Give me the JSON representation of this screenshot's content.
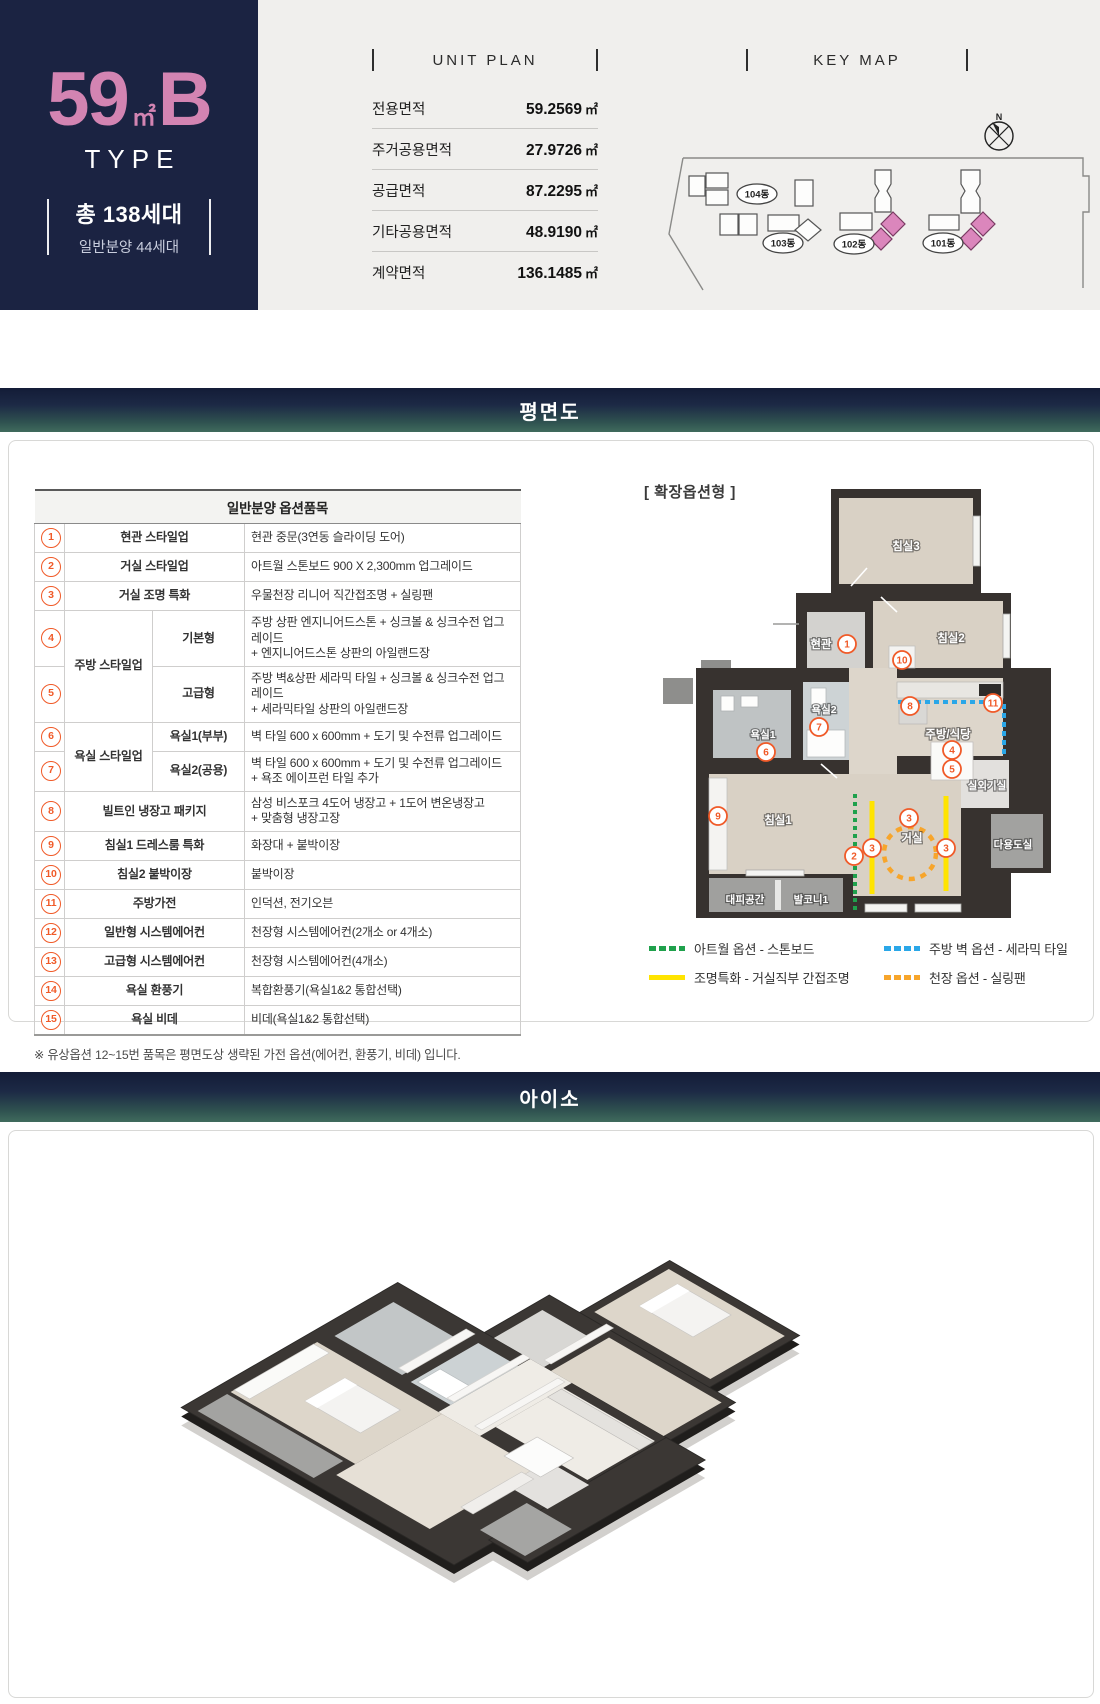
{
  "hero": {
    "size": "59",
    "size_unit": "㎡",
    "letter": "B",
    "type_label": "TYPE",
    "total_units": "총 138세대",
    "general_sale": "일반분양 44세대"
  },
  "unit_plan": {
    "title": "UNIT PLAN",
    "rows": [
      {
        "label": "전용면적",
        "value": "59.2569",
        "unit": "㎡"
      },
      {
        "label": "주거공용면적",
        "value": "27.9726",
        "unit": "㎡"
      },
      {
        "label": "공급면적",
        "value": "87.2295",
        "unit": "㎡"
      },
      {
        "label": "기타공용면적",
        "value": "48.9190",
        "unit": "㎡"
      },
      {
        "label": "계약면적",
        "value": "136.1485",
        "unit": "㎡"
      }
    ]
  },
  "key_map": {
    "title": "KEY MAP",
    "compass": "N",
    "building_labels": [
      "104동",
      "103동",
      "102동",
      "101동"
    ]
  },
  "floorplan": {
    "bar_title": "평면도",
    "variant": "[ 확장옵션형 ]",
    "table": {
      "title": "일반분양 옵션품목",
      "rows": [
        {
          "num": "1",
          "cat": "현관 스타일업",
          "desc1": "현관 중문(3연동 슬라이딩 도어)"
        },
        {
          "num": "2",
          "cat": "거실 스타일업",
          "desc1": "아트월 스톤보드 900 X 2,300mm 업그레이드"
        },
        {
          "num": "3",
          "cat": "거실 조명 특화",
          "desc1": "우물천장 리니어 직간접조명 + 실링팬"
        },
        {
          "num": "4",
          "group": "주방 스타일업",
          "sub": "기본형",
          "desc1": "주방 상판 엔지니어드스톤 + 싱크볼 & 싱크수전 업그레이드",
          "desc2": "+ 엔지니어드스톤 상판의 아일랜드장"
        },
        {
          "num": "5",
          "sub": "고급형",
          "desc1": "주방 벽&상판 세라믹 타일 + 싱크볼 & 싱크수전 업그레이드",
          "desc2": "+ 세라믹타일 상판의 아일랜드장"
        },
        {
          "num": "6",
          "group": "욕실 스타일업",
          "sub": "욕실1(부부)",
          "desc1": "벽 타일 600 x 600mm + 도기 및 수전류 업그레이드"
        },
        {
          "num": "7",
          "sub": "욕실2(공용)",
          "desc1": "벽 타일 600 x 600mm + 도기 및 수전류 업그레이드",
          "desc2": "+ 욕조 에이프런 타일 추가"
        },
        {
          "num": "8",
          "cat": "빌트인 냉장고 패키지",
          "desc1": "삼성 비스포크 4도어 냉장고 + 1도어 변온냉장고",
          "desc2": "+ 맞춤형 냉장고장"
        },
        {
          "num": "9",
          "cat": "침실1 드레스룸 특화",
          "desc1": "화장대 + 붙박이장"
        },
        {
          "num": "10",
          "cat": "침실2 붙박이장",
          "desc1": "붙박이장"
        },
        {
          "num": "11",
          "cat": "주방가전",
          "desc1": "인덕션, 전기오븐"
        },
        {
          "num": "12",
          "cat": "일반형 시스템에어컨",
          "desc1": "천장형 시스템에어컨(2개소 or 4개소)"
        },
        {
          "num": "13",
          "cat": "고급형 시스템에어컨",
          "desc1": "천장형 시스템에어컨(4개소)"
        },
        {
          "num": "14",
          "cat": "욕실 환풍기",
          "desc1": "복합환풍기(욕실1&2 통합선택)"
        },
        {
          "num": "15",
          "cat": "욕실 비데",
          "desc1": "비데(욕실1&2 통합선택)"
        }
      ]
    },
    "footnote": "※ 유상옵션 12~15번 품목은 평면도상 생략된 가전 옵션(에어컨, 환풍기, 비데) 입니다.",
    "rooms": {
      "bed3": "침실3",
      "bed2": "침실2",
      "entry": "현관",
      "bath2": "욕실2",
      "bath1": "욕실1",
      "kitchen": "주방/식당",
      "outdoor": "실외기실",
      "utility": "다용도실",
      "bed1": "침실1",
      "living": "거실",
      "shelter": "대피공간",
      "balcony1": "발코니1"
    },
    "marker_nums": [
      "1",
      "10",
      "8",
      "11",
      "7",
      "6",
      "4",
      "5",
      "9",
      "3",
      "3",
      "3",
      "2"
    ],
    "legend": [
      {
        "label": "아트월 옵션 - 스톤보드",
        "color": "#1fa14c",
        "style": "dashed"
      },
      {
        "label": "조명특화 - 거실직부 간접조명",
        "color": "#ffe400",
        "style": "solid"
      },
      {
        "label": "주방 벽 옵션 - 세라믹 타일",
        "color": "#2aa7e8",
        "style": "dashed"
      },
      {
        "label": "천장 옵션 - 실링팬",
        "color": "#f7a52b",
        "style": "dashed"
      }
    ]
  },
  "iso": {
    "bar_title": "아이소"
  },
  "colors": {
    "hero_navy": "#1b2342",
    "hero_pink": "#d384b2",
    "bar_gradient_top": "#131c37",
    "bar_gradient_bottom": "#406b5d",
    "marker_orange": "#f05a28",
    "top_strip_bg": "#f0efed"
  }
}
